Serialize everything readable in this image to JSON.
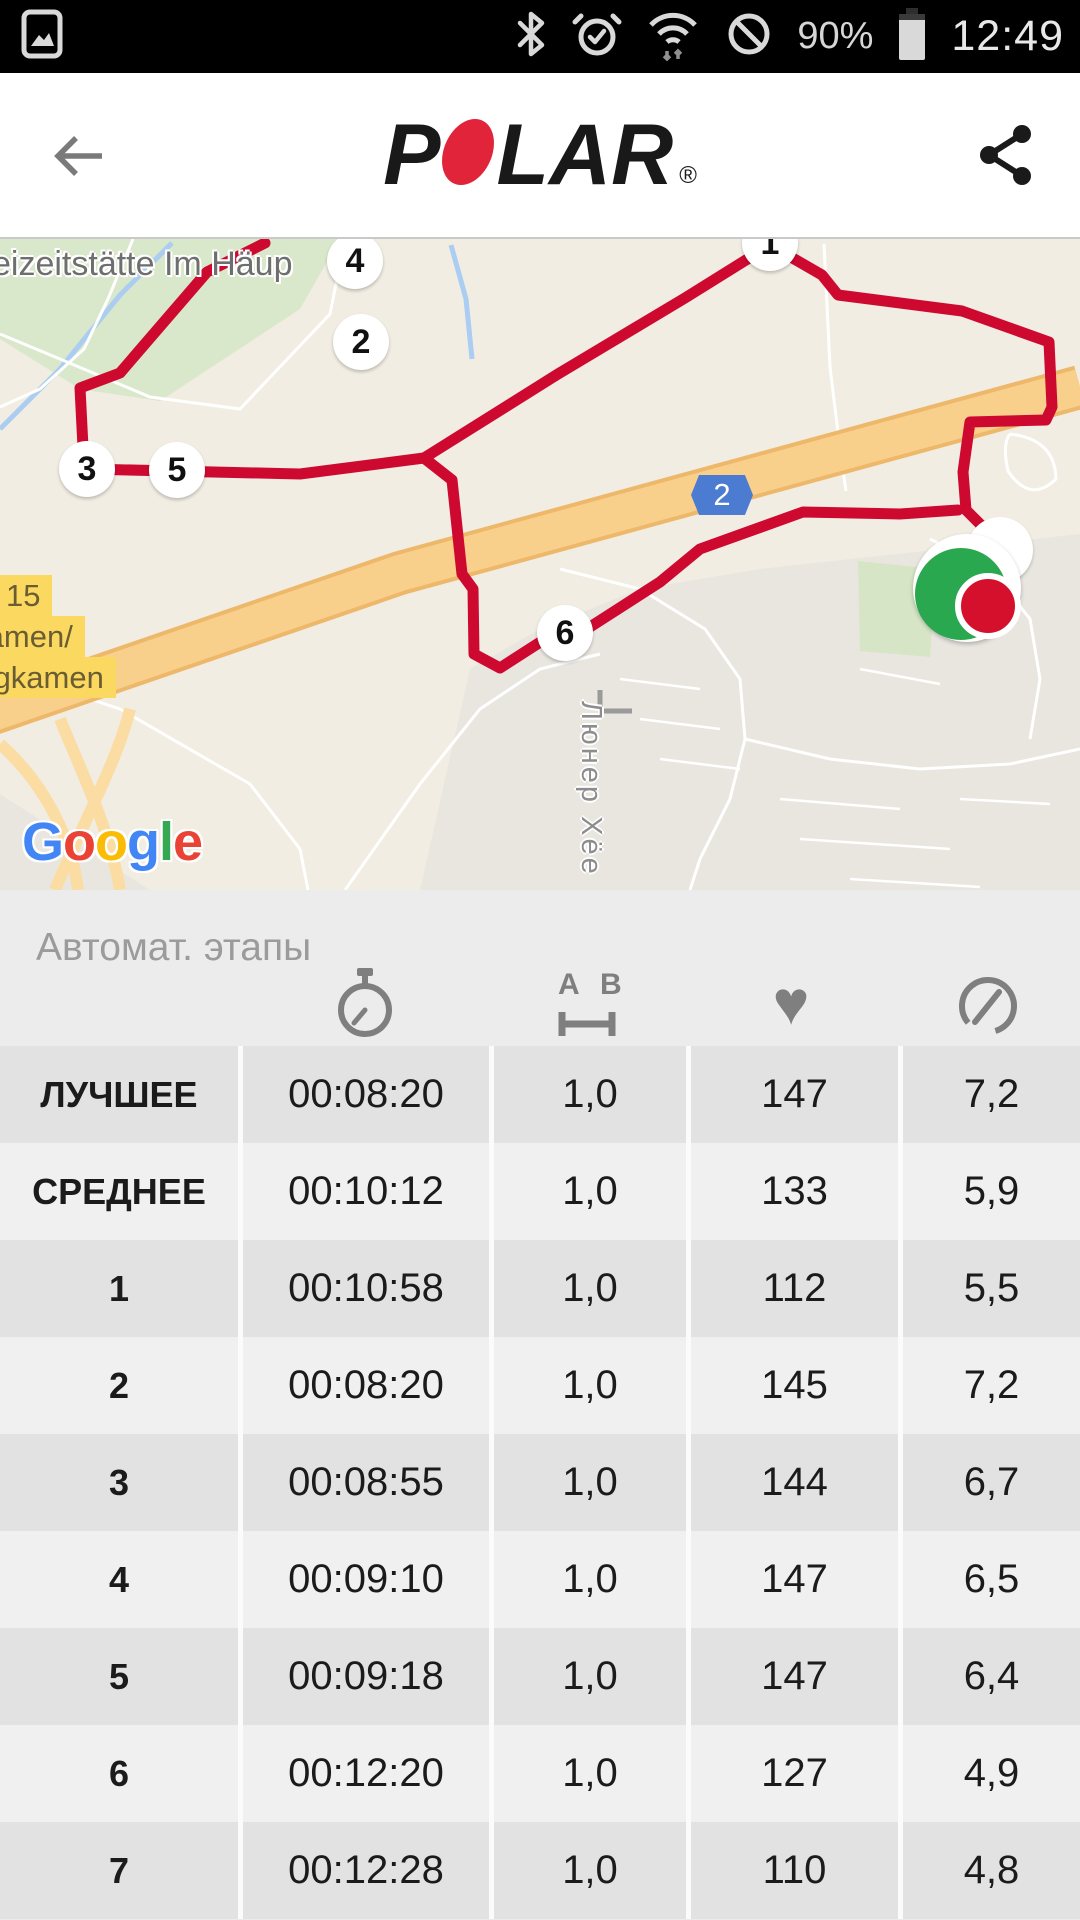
{
  "status_bar": {
    "time": "12:49",
    "battery_percent": "90%",
    "icons": [
      "screenshot-icon",
      "bluetooth-icon",
      "alarm-icon",
      "wifi-icon",
      "do-not-disturb-icon",
      "battery-icon"
    ]
  },
  "header": {
    "brand_p": "P",
    "brand_lar": "LAR",
    "registered_mark": "®"
  },
  "map": {
    "attribution_g1": "G",
    "attribution_o1": "o",
    "attribution_o2": "o",
    "attribution_g2": "g",
    "attribution_l": "l",
    "attribution_e": "e",
    "place_label": "eizeitstätte Im Häup",
    "street_label": "Люнер Хёе",
    "road_shield": "2",
    "exit_sign": {
      "line1": "15",
      "line2": "Kamen/",
      "line3": "ergkamen"
    },
    "lap_markers": [
      {
        "label": "1",
        "x": 770,
        "y": 4
      },
      {
        "label": "4",
        "x": 355,
        "y": 22
      },
      {
        "label": "2",
        "x": 361,
        "y": 103
      },
      {
        "label": "3",
        "x": 87,
        "y": 230
      },
      {
        "label": "5",
        "x": 177,
        "y": 231
      },
      {
        "label": "6",
        "x": 565,
        "y": 394
      }
    ],
    "colors": {
      "route": "#ce0930",
      "highway": "#f9cf8c",
      "start": "#2aa84f",
      "finish": "#d5102d",
      "shield": "#4c7bd2"
    }
  },
  "laps_table": {
    "title": "Автомат. этапы",
    "column_icons": [
      "stopwatch-icon",
      "distance-ab-icon",
      "heart-icon",
      "speedometer-icon"
    ],
    "distance_icon_a": "A",
    "distance_icon_b": "B",
    "rows": [
      {
        "label": "ЛУЧШЕЕ",
        "time": "00:08:20",
        "distance": "1,0",
        "heart_rate": "147",
        "speed": "7,2"
      },
      {
        "label": "СРЕДНЕЕ",
        "time": "00:10:12",
        "distance": "1,0",
        "heart_rate": "133",
        "speed": "5,9"
      },
      {
        "label": "1",
        "time": "00:10:58",
        "distance": "1,0",
        "heart_rate": "112",
        "speed": "5,5"
      },
      {
        "label": "2",
        "time": "00:08:20",
        "distance": "1,0",
        "heart_rate": "145",
        "speed": "7,2"
      },
      {
        "label": "3",
        "time": "00:08:55",
        "distance": "1,0",
        "heart_rate": "144",
        "speed": "6,7"
      },
      {
        "label": "4",
        "time": "00:09:10",
        "distance": "1,0",
        "heart_rate": "147",
        "speed": "6,5"
      },
      {
        "label": "5",
        "time": "00:09:18",
        "distance": "1,0",
        "heart_rate": "147",
        "speed": "6,4"
      },
      {
        "label": "6",
        "time": "00:12:20",
        "distance": "1,0",
        "heart_rate": "127",
        "speed": "4,9"
      },
      {
        "label": "7",
        "time": "00:12:28",
        "distance": "1,0",
        "heart_rate": "110",
        "speed": "4,8"
      }
    ]
  }
}
